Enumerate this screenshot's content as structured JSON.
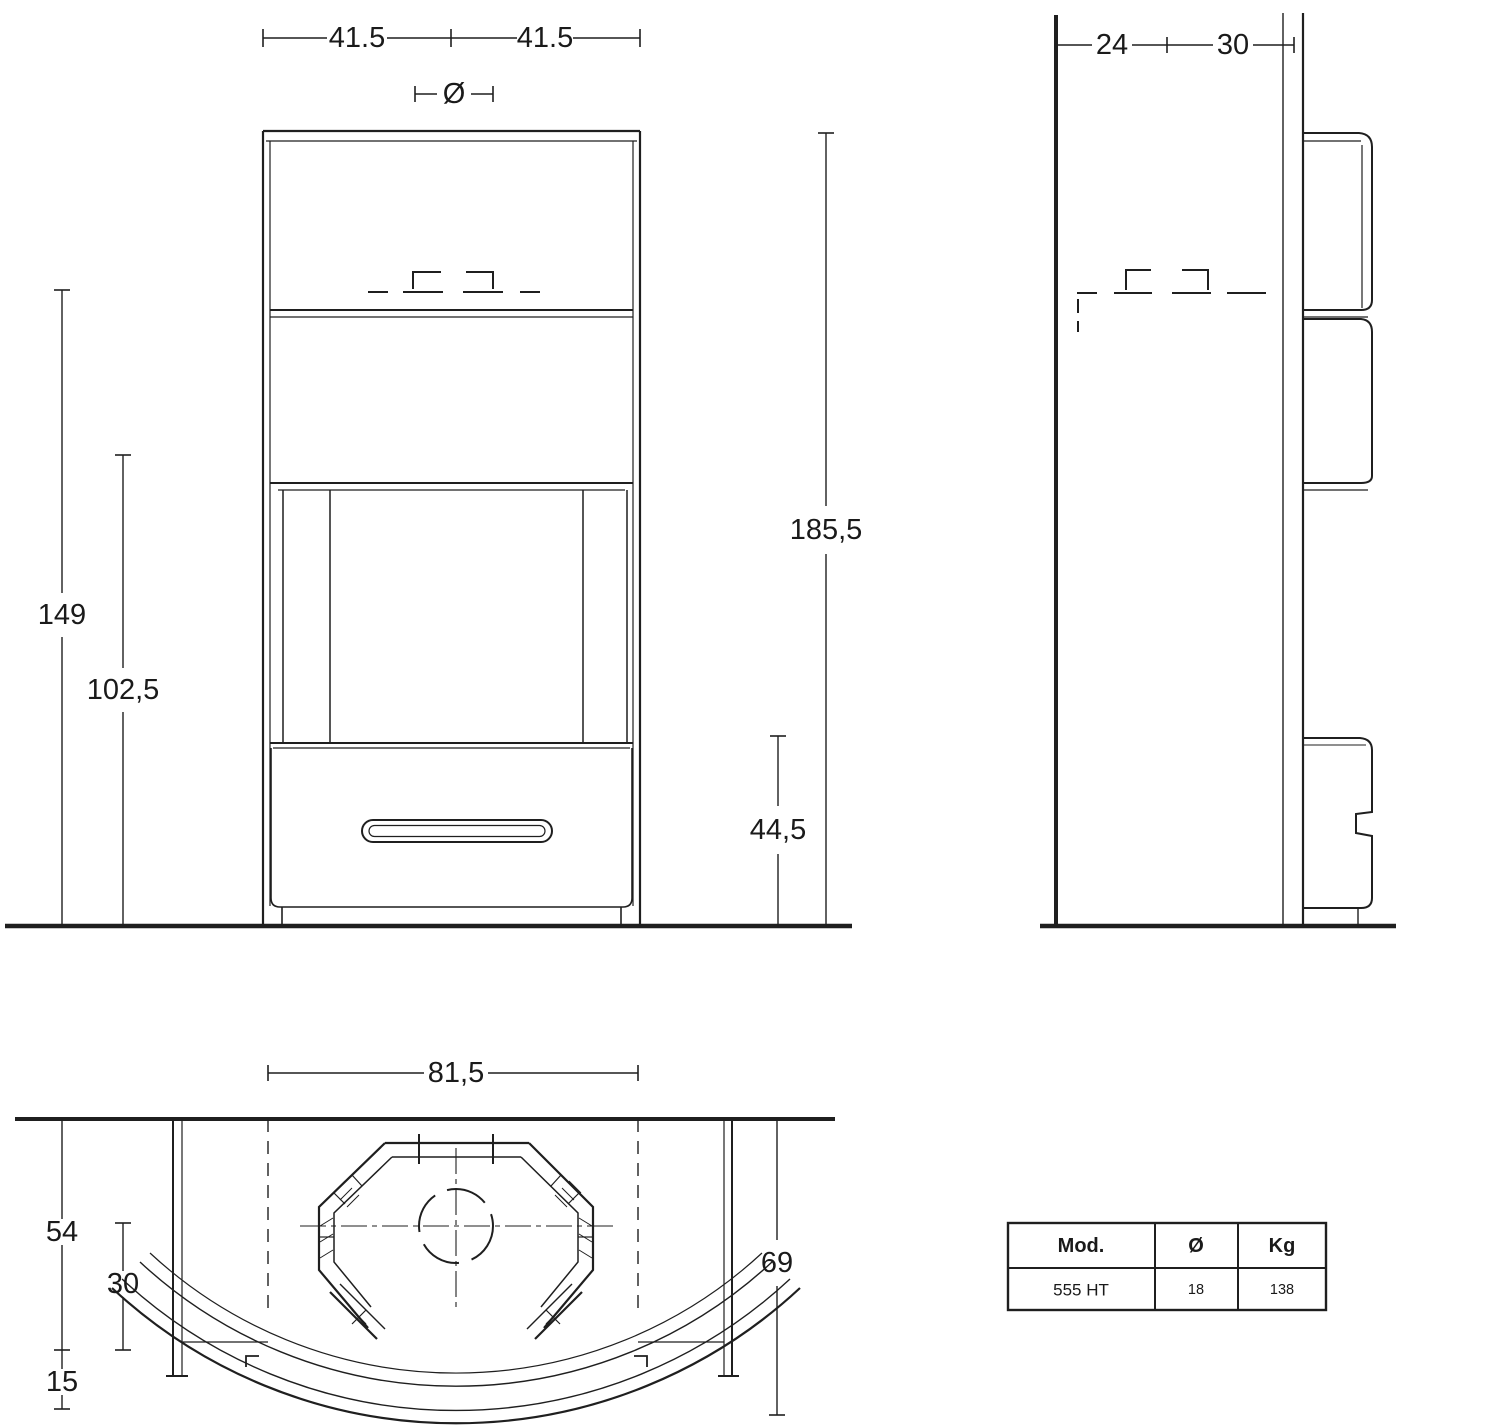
{
  "front_view": {
    "dim_half_width_left": "41.5",
    "dim_half_width_right": "41.5",
    "flue_diameter_symbol": "Ø",
    "dim_total_height": "185,5",
    "dim_flue_height": "149",
    "dim_mid_height": "102,5",
    "dim_base_height": "44,5"
  },
  "side_view": {
    "dim_wall_clearance": "24",
    "dim_back_depth": "30"
  },
  "top_view": {
    "dim_body_width": "81,5",
    "dim_total_depth": "69",
    "dim_side_depth": "54",
    "dim_recess_depth": "30",
    "dim_front_offset": "15"
  },
  "spec_table": {
    "headers": [
      "Mod.",
      "Ø",
      "Kg"
    ],
    "row": [
      "555 HT",
      "18",
      "138"
    ]
  },
  "colors": {
    "line": "#1f1f1f",
    "background": "#ffffff"
  }
}
